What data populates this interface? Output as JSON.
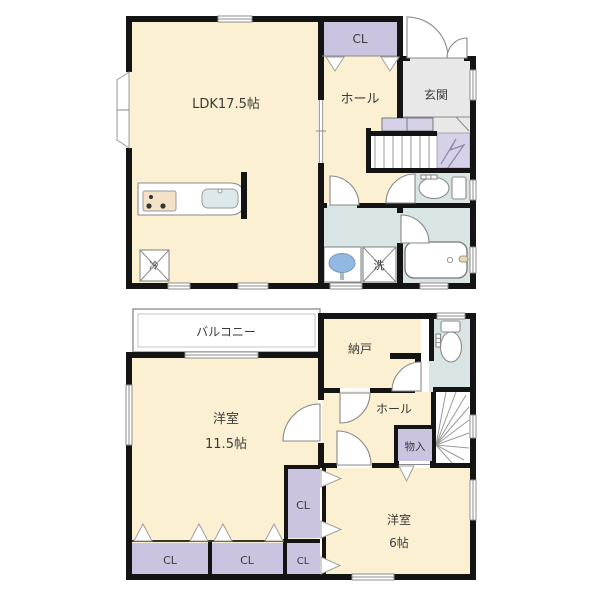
{
  "floor1": {
    "ldk": "LDK17.5帖",
    "closet": "CL",
    "hall": "ホール",
    "entrance": "玄関",
    "laundry": "洗",
    "refrigerator": "冷"
  },
  "floor2": {
    "balcony": "バルコニー",
    "storage": "納戸",
    "hall": "ホール",
    "bedroom1": "洋室",
    "bedroom1_size": "11.5帖",
    "storage_box": "物入",
    "closet_right": "CL",
    "closet_small": "CL",
    "closet_left": "CL",
    "closet_mid": "CL",
    "bedroom2": "洋室",
    "bedroom2_size": "6帖"
  },
  "colors": {
    "room": "#fbf0d2",
    "closet": "#cbc4e0",
    "entrance": "#e8e8e8",
    "wet_area": "#d9e5e4",
    "stairs_accent": "#d6d0e8",
    "wall": "#141414",
    "window": "#8c8c8c",
    "sink_blue": "#92b9e2",
    "counter_tan": "#f3e2c8"
  }
}
